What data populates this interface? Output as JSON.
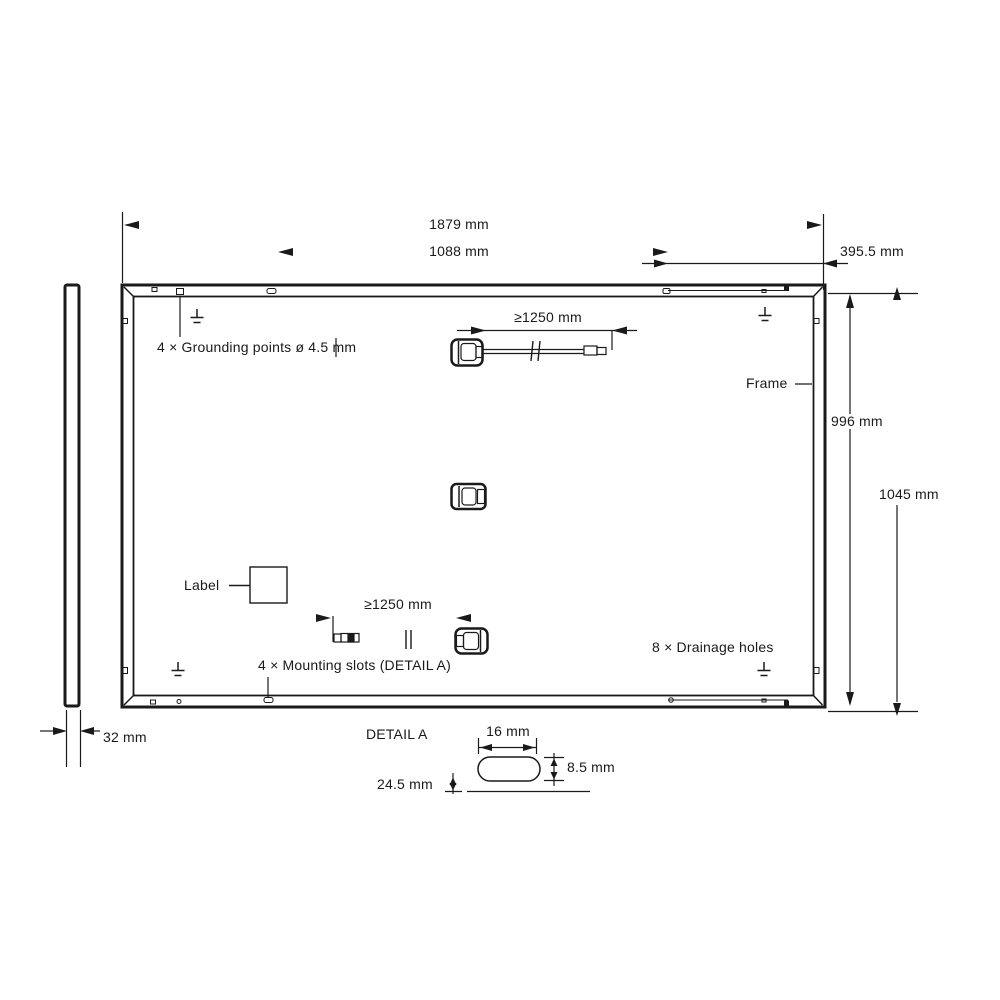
{
  "drawing": {
    "dimensions": {
      "panel_width": "1879 mm",
      "mount_slot_spacing_horizontal": "1088 mm",
      "mount_slot_edge_offset": "395.5 mm",
      "mount_slot_spacing_vertical": "996 mm",
      "panel_height": "1045 mm",
      "panel_thickness": "32 mm",
      "cable_length_top": "≥1250 mm",
      "cable_length_bottom": "≥1250 mm",
      "detail_slot_width": "16 mm",
      "detail_slot_height": "8.5 mm",
      "detail_slot_offset": "24.5 mm"
    },
    "annotations": {
      "grounding_points": "4 × Grounding points ø 4.5 mm",
      "frame": "Frame",
      "label": "Label",
      "mounting_slots": "4 × Mounting slots (DETAIL A)",
      "drainage_holes": "8 × Drainage holes",
      "detail_title": "DETAIL A"
    },
    "colors": {
      "line": "#1a1a1a",
      "background": "#ffffff"
    }
  }
}
